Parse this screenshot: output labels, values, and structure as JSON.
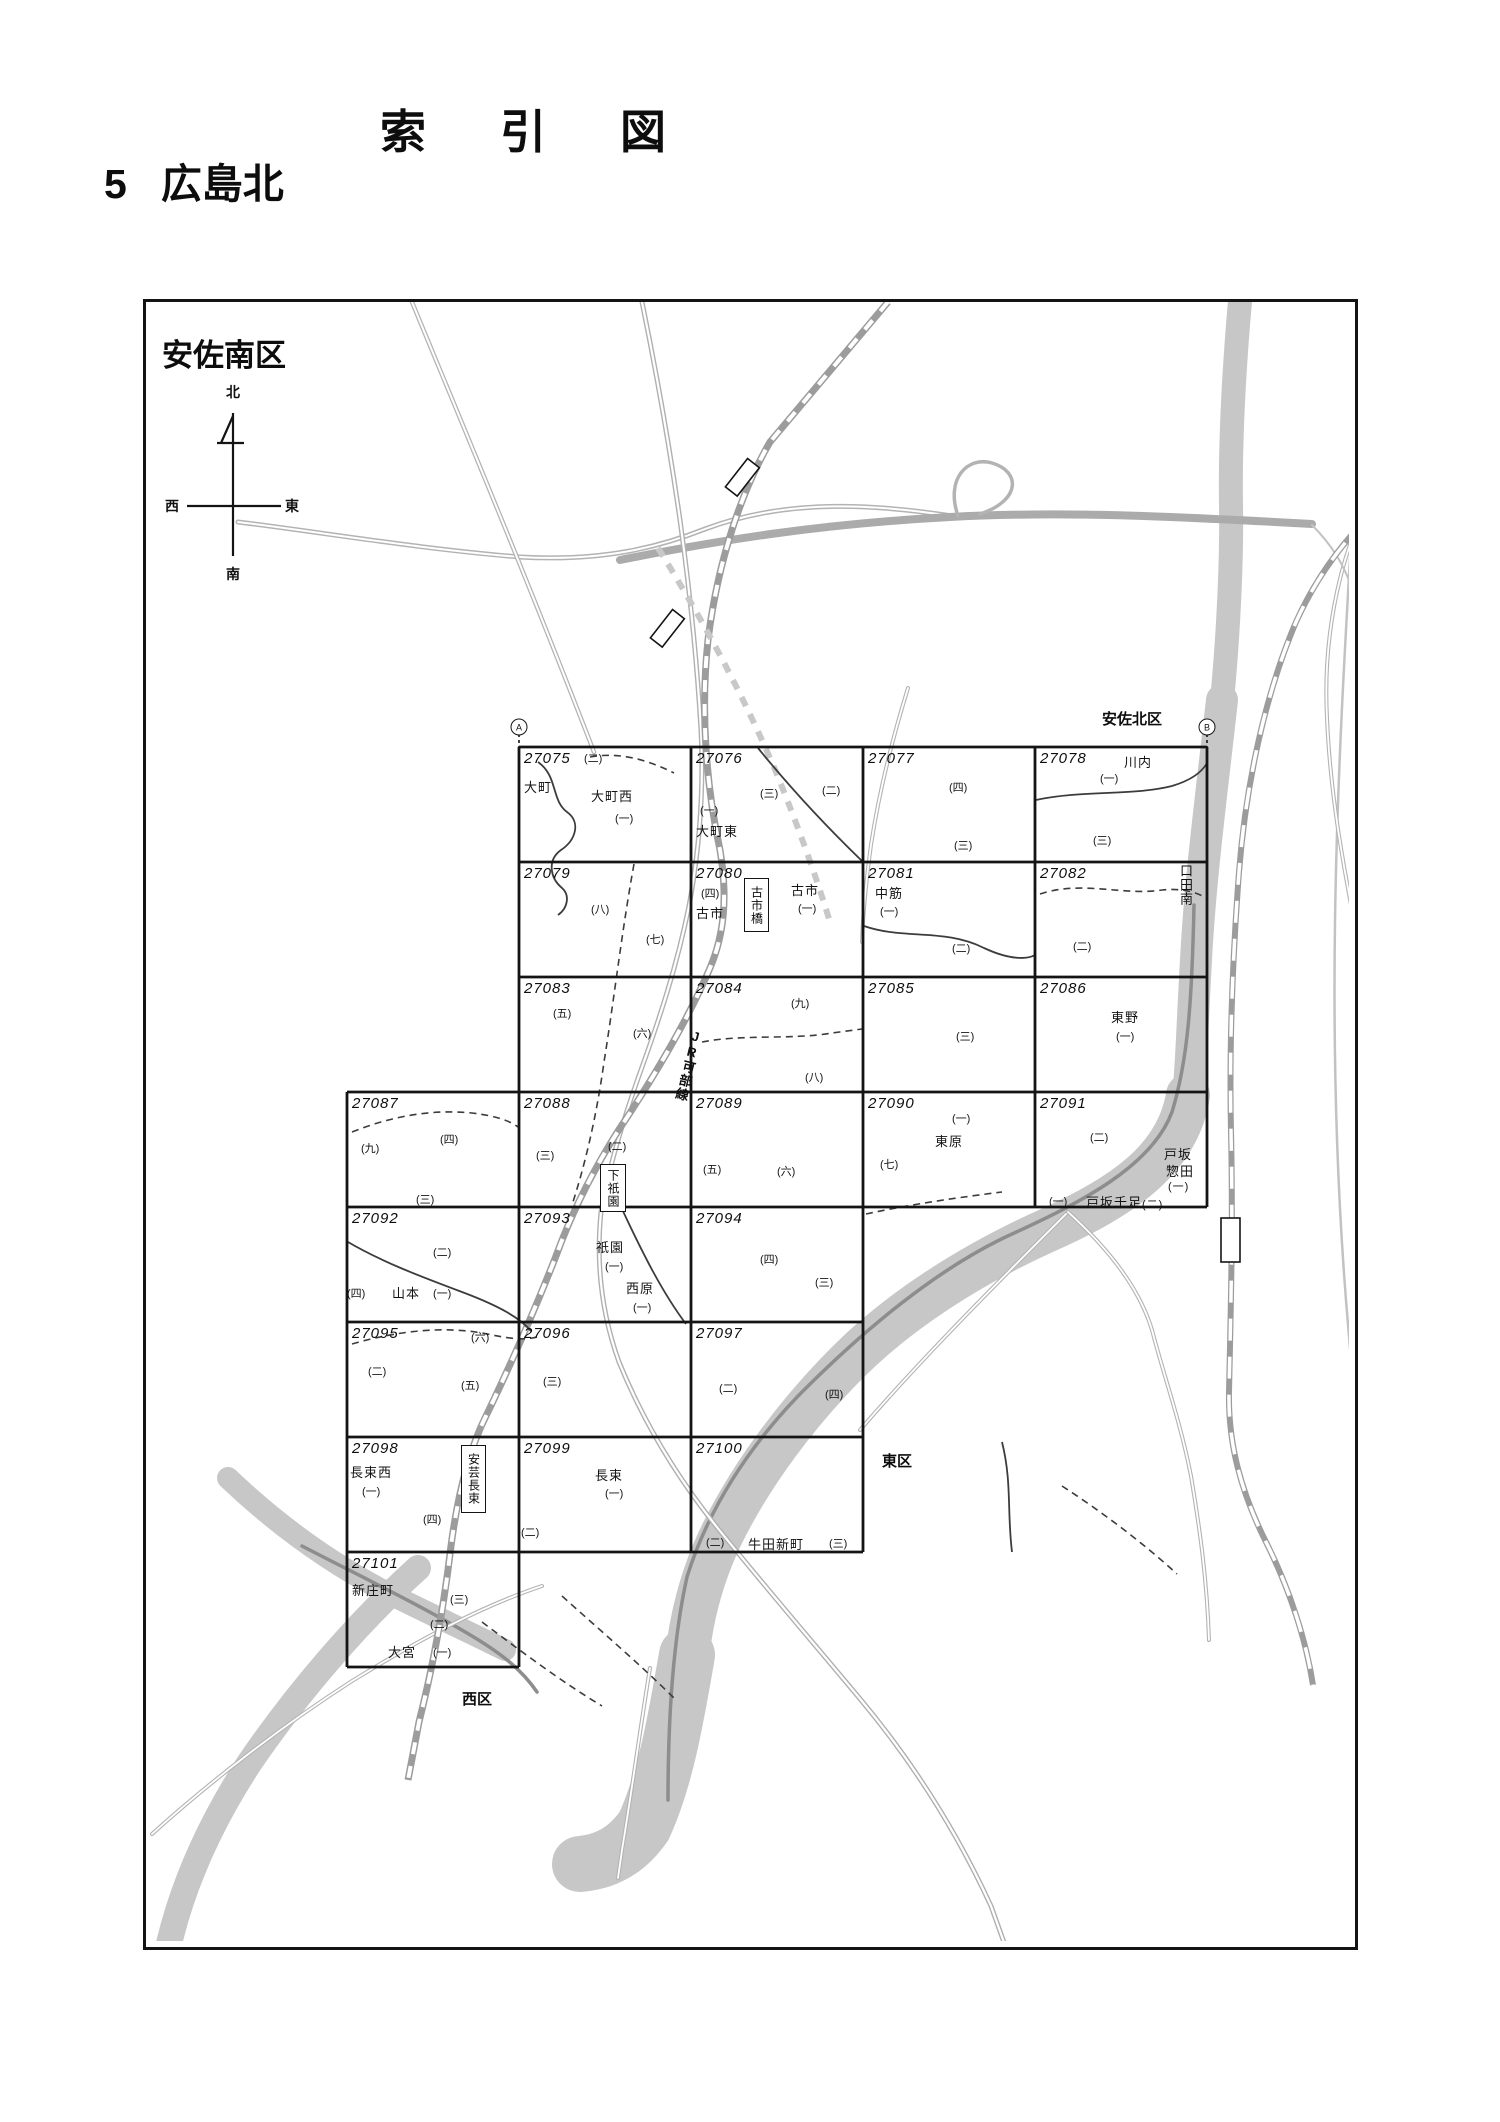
{
  "page": {
    "title": "索引図",
    "section_number": "5",
    "section_name": "広島北"
  },
  "map": {
    "region_labels": [
      {
        "text": "安佐南区",
        "x": 162,
        "y": 330,
        "size": 31
      },
      {
        "text": "安佐北区",
        "x": 1102,
        "y": 708,
        "size": 15
      },
      {
        "text": "西区",
        "x": 462,
        "y": 1688,
        "size": 15
      },
      {
        "text": "東区",
        "x": 882,
        "y": 1450,
        "size": 15
      }
    ],
    "compass": {
      "north": "北",
      "south": "南",
      "east": "東",
      "west": "西"
    },
    "corner_markers": [
      {
        "text": "A",
        "x": 519,
        "y": 727
      },
      {
        "text": "B",
        "x": 1207,
        "y": 727
      }
    ],
    "railway_label": {
      "text": "JR可部線",
      "x": 681,
      "y": 1028
    },
    "stations": [
      {
        "name": "古市橋",
        "x": 744,
        "y": 878,
        "w": 23,
        "h": 52
      },
      {
        "name": "下祇園",
        "x": 600,
        "y": 1164,
        "w": 24,
        "h": 46
      },
      {
        "name": "安芸長束",
        "x": 461,
        "y": 1445,
        "w": 23,
        "h": 66
      }
    ],
    "outside_labels": [
      {
        "text": "口田南",
        "x": 1176,
        "y": 864,
        "size": 13,
        "vertical": true
      },
      {
        "text": "戸坂",
        "x": 1164,
        "y": 1144,
        "size": 13
      },
      {
        "text": "惣田",
        "x": 1166,
        "y": 1161,
        "size": 13
      },
      {
        "text": "(一)",
        "x": 1168,
        "y": 1178,
        "size": 11
      },
      {
        "text": "戸坂千足",
        "x": 1086,
        "y": 1192,
        "size": 13
      },
      {
        "text": "(二)",
        "x": 1142,
        "y": 1196,
        "size": 11
      }
    ],
    "grid": {
      "cells": [
        {
          "id": "27075",
          "row": 0,
          "col": 1,
          "labels": [
            {
              "t": "(二)",
              "fx": 0.38,
              "fy": 0.03,
              "cls": "p"
            },
            {
              "t": "大町",
              "fx": 0.03,
              "fy": 0.26,
              "cls": "n"
            },
            {
              "t": "大町西",
              "fx": 0.42,
              "fy": 0.34,
              "cls": "n"
            },
            {
              "t": "(一)",
              "fx": 0.56,
              "fy": 0.55,
              "cls": "p"
            }
          ]
        },
        {
          "id": "27076",
          "row": 0,
          "col": 2,
          "labels": [
            {
              "t": "(三)",
              "fx": 0.4,
              "fy": 0.33,
              "cls": "p"
            },
            {
              "t": "(二)",
              "fx": 0.76,
              "fy": 0.3,
              "cls": "p"
            },
            {
              "t": "(一)",
              "fx": 0.05,
              "fy": 0.48,
              "cls": "p"
            },
            {
              "t": "大町東",
              "fx": 0.03,
              "fy": 0.64,
              "cls": "n"
            }
          ]
        },
        {
          "id": "27077",
          "row": 0,
          "col": 3,
          "labels": [
            {
              "t": "(四)",
              "fx": 0.5,
              "fy": 0.28,
              "cls": "p"
            },
            {
              "t": "(三)",
              "fx": 0.53,
              "fy": 0.78,
              "cls": "p"
            }
          ]
        },
        {
          "id": "27078",
          "row": 0,
          "col": 4,
          "labels": [
            {
              "t": "川内",
              "fx": 0.52,
              "fy": 0.04,
              "cls": "n"
            },
            {
              "t": "(一)",
              "fx": 0.38,
              "fy": 0.2,
              "cls": "p"
            },
            {
              "t": "(三)",
              "fx": 0.34,
              "fy": 0.74,
              "cls": "p"
            }
          ]
        },
        {
          "id": "27079",
          "row": 1,
          "col": 1,
          "labels": [
            {
              "t": "(八)",
              "fx": 0.42,
              "fy": 0.34,
              "cls": "p"
            },
            {
              "t": "(七)",
              "fx": 0.74,
              "fy": 0.6,
              "cls": "p"
            }
          ]
        },
        {
          "id": "27080",
          "row": 1,
          "col": 2,
          "labels": [
            {
              "t": "(四)",
              "fx": 0.06,
              "fy": 0.2,
              "cls": "p"
            },
            {
              "t": "古市",
              "fx": 0.03,
              "fy": 0.36,
              "cls": "n"
            },
            {
              "t": "古市",
              "fx": 0.58,
              "fy": 0.16,
              "cls": "n"
            },
            {
              "t": "(一)",
              "fx": 0.62,
              "fy": 0.33,
              "cls": "p"
            }
          ]
        },
        {
          "id": "27081",
          "row": 1,
          "col": 3,
          "labels": [
            {
              "t": "中筋",
              "fx": 0.07,
              "fy": 0.18,
              "cls": "n"
            },
            {
              "t": "(一)",
              "fx": 0.1,
              "fy": 0.36,
              "cls": "p"
            },
            {
              "t": "(二)",
              "fx": 0.52,
              "fy": 0.68,
              "cls": "p"
            }
          ]
        },
        {
          "id": "27082",
          "row": 1,
          "col": 4,
          "labels": [
            {
              "t": "(二)",
              "fx": 0.22,
              "fy": 0.66,
              "cls": "p"
            }
          ]
        },
        {
          "id": "27083",
          "row": 2,
          "col": 1,
          "labels": [
            {
              "t": "(五)",
              "fx": 0.2,
              "fy": 0.24,
              "cls": "p"
            },
            {
              "t": "(六)",
              "fx": 0.66,
              "fy": 0.42,
              "cls": "p"
            }
          ]
        },
        {
          "id": "27084",
          "row": 2,
          "col": 2,
          "labels": [
            {
              "t": "(九)",
              "fx": 0.58,
              "fy": 0.16,
              "cls": "p"
            },
            {
              "t": "(八)",
              "fx": 0.66,
              "fy": 0.8,
              "cls": "p"
            }
          ]
        },
        {
          "id": "27085",
          "row": 2,
          "col": 3,
          "labels": [
            {
              "t": "(三)",
              "fx": 0.54,
              "fy": 0.44,
              "cls": "p"
            }
          ]
        },
        {
          "id": "27086",
          "row": 2,
          "col": 4,
          "labels": [
            {
              "t": "東野",
              "fx": 0.44,
              "fy": 0.26,
              "cls": "n"
            },
            {
              "t": "(一)",
              "fx": 0.47,
              "fy": 0.44,
              "cls": "p"
            }
          ]
        },
        {
          "id": "27087",
          "row": 3,
          "col": 0,
          "labels": [
            {
              "t": "(九)",
              "fx": 0.08,
              "fy": 0.42,
              "cls": "p"
            },
            {
              "t": "(四)",
              "fx": 0.54,
              "fy": 0.34,
              "cls": "p"
            },
            {
              "t": "(三)",
              "fx": 0.4,
              "fy": 0.86,
              "cls": "p"
            }
          ]
        },
        {
          "id": "27088",
          "row": 3,
          "col": 1,
          "labels": [
            {
              "t": "(三)",
              "fx": 0.1,
              "fy": 0.48,
              "cls": "p"
            },
            {
              "t": "(二)",
              "fx": 0.52,
              "fy": 0.4,
              "cls": "p"
            }
          ]
        },
        {
          "id": "27089",
          "row": 3,
          "col": 2,
          "labels": [
            {
              "t": "(五)",
              "fx": 0.07,
              "fy": 0.6,
              "cls": "p"
            },
            {
              "t": "(六)",
              "fx": 0.5,
              "fy": 0.62,
              "cls": "p"
            }
          ]
        },
        {
          "id": "27090",
          "row": 3,
          "col": 3,
          "labels": [
            {
              "t": "(一)",
              "fx": 0.52,
              "fy": 0.16,
              "cls": "p"
            },
            {
              "t": "東原",
              "fx": 0.42,
              "fy": 0.34,
              "cls": "n"
            },
            {
              "t": "(七)",
              "fx": 0.1,
              "fy": 0.56,
              "cls": "p"
            }
          ]
        },
        {
          "id": "27091",
          "row": 3,
          "col": 4,
          "labels": [
            {
              "t": "(二)",
              "fx": 0.32,
              "fy": 0.32,
              "cls": "p"
            },
            {
              "t": "(一)",
              "fx": 0.08,
              "fy": 0.88,
              "cls": "p"
            }
          ]
        },
        {
          "id": "27092",
          "row": 4,
          "col": 0,
          "labels": [
            {
              "t": "(二)",
              "fx": 0.5,
              "fy": 0.32,
              "cls": "p"
            },
            {
              "t": "(四)",
              "fx": 0.0,
              "fy": 0.68,
              "cls": "p"
            },
            {
              "t": "山本",
              "fx": 0.26,
              "fy": 0.66,
              "cls": "n"
            },
            {
              "t": "(一)",
              "fx": 0.5,
              "fy": 0.68,
              "cls": "p"
            }
          ]
        },
        {
          "id": "27093",
          "row": 4,
          "col": 1,
          "labels": [
            {
              "t": "祇園",
              "fx": 0.45,
              "fy": 0.26,
              "cls": "n"
            },
            {
              "t": "(一)",
              "fx": 0.5,
              "fy": 0.44,
              "cls": "p"
            },
            {
              "t": "西原",
              "fx": 0.62,
              "fy": 0.62,
              "cls": "n"
            },
            {
              "t": "(一)",
              "fx": 0.66,
              "fy": 0.8,
              "cls": "p"
            }
          ]
        },
        {
          "id": "27094",
          "row": 4,
          "col": 2,
          "labels": [
            {
              "t": "(四)",
              "fx": 0.4,
              "fy": 0.38,
              "cls": "p"
            },
            {
              "t": "(三)",
              "fx": 0.72,
              "fy": 0.58,
              "cls": "p"
            }
          ]
        },
        {
          "id": "27095",
          "row": 5,
          "col": 0,
          "labels": [
            {
              "t": "(六)",
              "fx": 0.72,
              "fy": 0.06,
              "cls": "p"
            },
            {
              "t": "(二)",
              "fx": 0.12,
              "fy": 0.36,
              "cls": "p"
            },
            {
              "t": "(五)",
              "fx": 0.66,
              "fy": 0.48,
              "cls": "p"
            }
          ]
        },
        {
          "id": "27096",
          "row": 5,
          "col": 1,
          "labels": [
            {
              "t": "(三)",
              "fx": 0.14,
              "fy": 0.44,
              "cls": "p"
            }
          ]
        },
        {
          "id": "27097",
          "row": 5,
          "col": 2,
          "labels": [
            {
              "t": "(二)",
              "fx": 0.16,
              "fy": 0.5,
              "cls": "p"
            },
            {
              "t": "(四)",
              "fx": 0.78,
              "fy": 0.56,
              "cls": "p"
            }
          ]
        },
        {
          "id": "27098",
          "row": 6,
          "col": 0,
          "labels": [
            {
              "t": "長束西",
              "fx": 0.02,
              "fy": 0.22,
              "cls": "n"
            },
            {
              "t": "(一)",
              "fx": 0.09,
              "fy": 0.4,
              "cls": "p"
            },
            {
              "t": "(四)",
              "fx": 0.44,
              "fy": 0.64,
              "cls": "p"
            }
          ]
        },
        {
          "id": "27099",
          "row": 6,
          "col": 1,
          "labels": [
            {
              "t": "長束",
              "fx": 0.44,
              "fy": 0.24,
              "cls": "n"
            },
            {
              "t": "(一)",
              "fx": 0.5,
              "fy": 0.42,
              "cls": "p"
            },
            {
              "t": "(二)",
              "fx": 0.01,
              "fy": 0.76,
              "cls": "p"
            }
          ]
        },
        {
          "id": "27100",
          "row": 6,
          "col": 2,
          "labels": [
            {
              "t": "(二)",
              "fx": 0.09,
              "fy": 0.84,
              "cls": "p"
            },
            {
              "t": "牛田新町",
              "fx": 0.33,
              "fy": 0.84,
              "cls": "n"
            },
            {
              "t": "(三)",
              "fx": 0.8,
              "fy": 0.85,
              "cls": "p"
            }
          ]
        },
        {
          "id": "27101",
          "row": 7,
          "col": 0,
          "labels": [
            {
              "t": "新庄町",
              "fx": 0.03,
              "fy": 0.24,
              "cls": "n"
            },
            {
              "t": "(三)",
              "fx": 0.6,
              "fy": 0.34,
              "cls": "p"
            },
            {
              "t": "(二)",
              "fx": 0.48,
              "fy": 0.56,
              "cls": "p"
            },
            {
              "t": "大宮",
              "fx": 0.24,
              "fy": 0.78,
              "cls": "n"
            },
            {
              "t": "(一)",
              "fx": 0.5,
              "fy": 0.8,
              "cls": "p"
            }
          ]
        }
      ]
    }
  }
}
